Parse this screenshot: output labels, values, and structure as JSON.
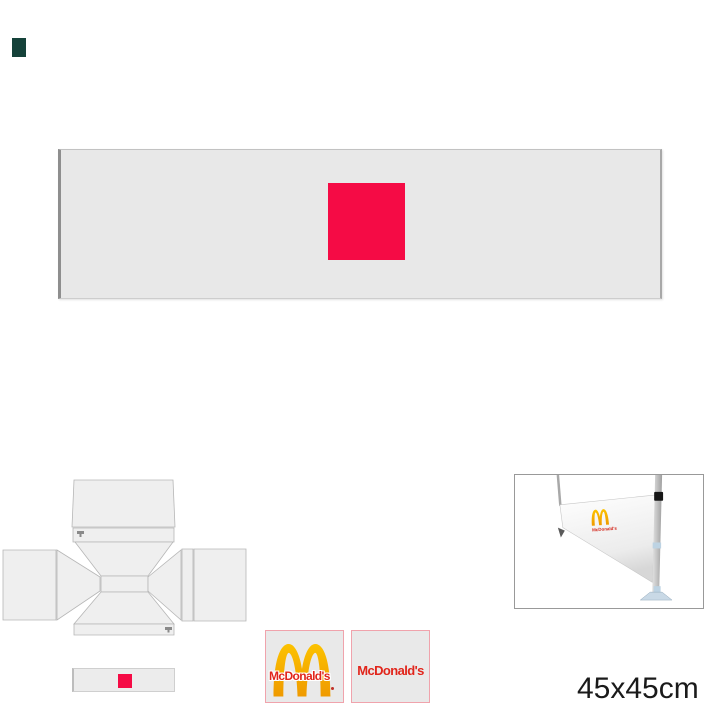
{
  "page": {
    "background": "#ffffff",
    "size_label": "45x45cm"
  },
  "color_swatch": {
    "color": "#15423a"
  },
  "banner_preview": {
    "fill": "#e8e8e8",
    "border": "#a8a8a8",
    "print_square_color": "#f50b45"
  },
  "mini_banner_preview": {
    "fill": "#ececec",
    "print_square_color": "#f50b45"
  },
  "tent_template": {
    "panel_fill": "#efefef",
    "panel_stroke": "#b6b6b6",
    "mark_color": "#8a8a8a"
  },
  "logo_thumbnails": {
    "border_color": "#f0a3ac",
    "background": "#e9e9e9",
    "brand_red": "#e1251b",
    "brand_gold_top": "#fcc200",
    "brand_gold_bottom": "#ef9a00",
    "items": [
      {
        "label": "McDonald's"
      },
      {
        "label": "McDonald's"
      }
    ]
  },
  "product_photo": {
    "logo_text": "McDonald's",
    "frame_border": "#999999",
    "fabric_light": "#ffffff",
    "fabric_shade": "#d7d7d7",
    "pole_light": "#e2e2e2",
    "pole_dark": "#9f9f9f",
    "clamp_color": "#161616",
    "accent_blue": "#bdd3e3"
  }
}
